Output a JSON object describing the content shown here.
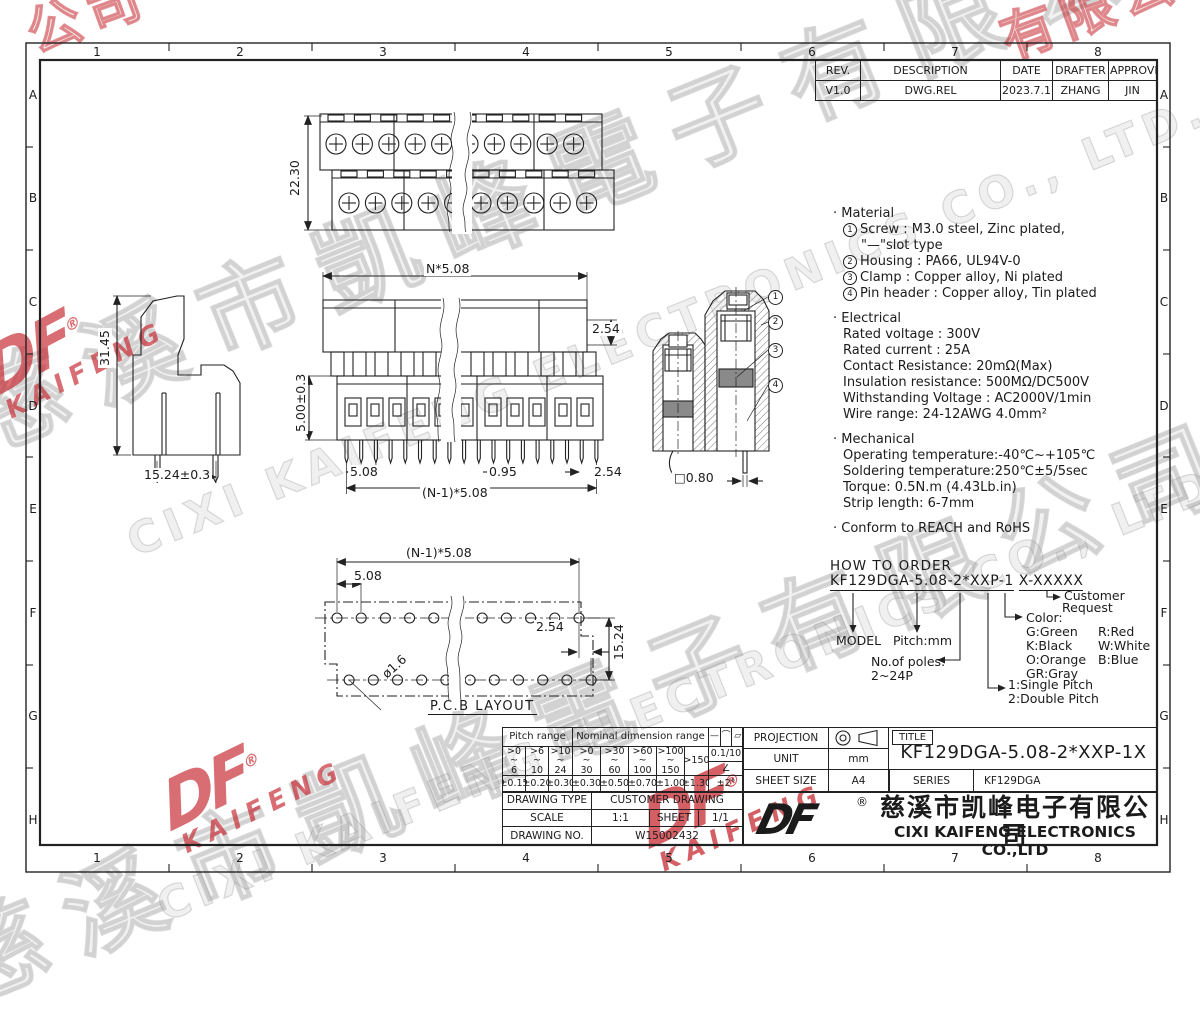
{
  "page": {
    "line_color": "#222222",
    "stamp_red": "#c4232b",
    "watermark_gray": "#969696"
  },
  "grid": {
    "cols": [
      "1",
      "2",
      "3",
      "4",
      "5",
      "6",
      "7",
      "8"
    ],
    "rows": [
      "A",
      "B",
      "C",
      "D",
      "E",
      "F",
      "G",
      "H"
    ]
  },
  "rev": {
    "h": [
      "REV.",
      "DESCRIPTION",
      "DATE",
      "DRAFTER",
      "APPROVER"
    ],
    "v": [
      "V1.0",
      "DWG.REL",
      "2023.7.17",
      "ZHANG",
      "JIN"
    ]
  },
  "specs": {
    "bullet": "·",
    "material": {
      "title": "Material",
      "n1": "1",
      "l1": "Screw : M3.0 steel, Zinc plated,",
      "l1b": "\"—\"slot type",
      "n2": "2",
      "l2": "Housing : PA66, UL94V-0",
      "n3": "3",
      "l3": "Clamp : Copper alloy, Ni plated",
      "n4": "4",
      "l4": "Pin header : Copper alloy, Tin plated"
    },
    "electrical": {
      "title": "Electrical",
      "l1": "Rated voltage : 300V",
      "l2": "Rated current : 25A",
      "l3": "Contact Resistance: 20mΩ(Max)",
      "l4": "Insulation resistance: 500MΩ/DC500V",
      "l5": "Withstanding Voltage : AC2000V/1min",
      "l6": "Wire range: 24-12AWG  4.0mm²"
    },
    "mechanical": {
      "title": "Mechanical",
      "l1": "Operating temperature:-40℃~+105℃",
      "l2": "Soldering temperature:250℃±5/5sec",
      "l3": "Torque: 0.5N.m (4.43Lb.in)",
      "l4": "Strip length: 6-7mm"
    },
    "conform": "Conform to REACH and RoHS"
  },
  "order": {
    "title": "HOW TO ORDER",
    "pn1": "KF129DGA-5.08-2*XXP-1",
    "pn2": "X-XXXXX",
    "model": "MODEL",
    "pitch": "Pitch:mm",
    "poles1": "No.of poles:",
    "poles2": "2~24P",
    "sp1": "1:Single Pitch",
    "sp2": "2:Double Pitch",
    "color_title": "Color:",
    "c1": "G:Green",
    "c2": "K:Black",
    "c3": "O:Orange",
    "c4": "GR:Gray",
    "c5": "R:Red",
    "c6": "W:White",
    "c7": "B:Blue",
    "cust1": "Customer",
    "cust2": "Request"
  },
  "dims": {
    "tv_h": "22.30",
    "fv_top": "N*5.08",
    "fv_right": "2.54",
    "fv_left": "5.00±0.3",
    "fv_b1": "5.08",
    "fv_b2": "0.95",
    "fv_b3": "2.54",
    "fv_b4": "(N-1)*5.08",
    "sv_h": "31.45",
    "sv_w": "15.24±0.3",
    "sec_sq": "□0.80",
    "pcb_top": "(N-1)*5.08",
    "pcb_p": "5.08",
    "pcb_off": "2.54",
    "pcb_h": "15.24",
    "pcb_hole": "ø1.6",
    "pcb_label": "P.C.B LAYOUT"
  },
  "callouts": {
    "c1": "1",
    "c2": "2",
    "c3": "3",
    "c4": "4"
  },
  "tol": {
    "pitch_header": "Pitch range",
    "nominal_header": "Nominal dimension range",
    "sym1": "—",
    "sym2": "⌒",
    "sym3": "▱",
    "p1": ">0\n~\n6",
    "p2": ">6\n~\n10",
    "p3": ">10\n~\n24",
    "n1": ">0\n~\n30",
    "n2": ">30\n~\n60",
    "n3": ">60\n~\n100",
    "n4": ">100\n~\n150",
    "n5": ">150",
    "flat": "0.1/10",
    "angle_sym": "∠",
    "t1": "±0.15",
    "t2": "±0.20",
    "t3": "±0.30",
    "t4": "±0.30",
    "t5": "±0.50",
    "t6": "±0.70",
    "t7": "±1.00",
    "t8": "±1.30",
    "t9": "±2°"
  },
  "tb": {
    "projection": "PROJECTION",
    "unit_label": "UNIT",
    "unit": "mm",
    "sheet_size_label": "SHEET SIZE",
    "sheet_size": "A4",
    "title_label": "TITLE",
    "title": "KF129DGA-5.08-2*XXP-1X",
    "series_label": "SERIES",
    "series": "KF129DGA",
    "dt_label": "DRAWING TYPE",
    "dt": "CUSTOMER DRAWING",
    "scale_label": "SCALE",
    "scale": "1:1",
    "sheet_label": "SHEET",
    "sheet": "1/1",
    "no_label": "DRAWING NO.",
    "no": "W15002432",
    "company_cn": "慈溪市凯峰电子有限公司",
    "company_en": "CIXI KAIFENG ELECTRONICS CO.,LTD",
    "logo": "DF",
    "reg": "®"
  },
  "wm": {
    "cn": "慈溪市凱峰電子有限公司",
    "en": "CIXI KAIFENG ELECTRONICS CO., LTD.",
    "logo": "DF",
    "logo_sub": "KAIFENG",
    "reg": "®",
    "cn_frag1": "公司",
    "cn_frag2": "有限公司"
  }
}
